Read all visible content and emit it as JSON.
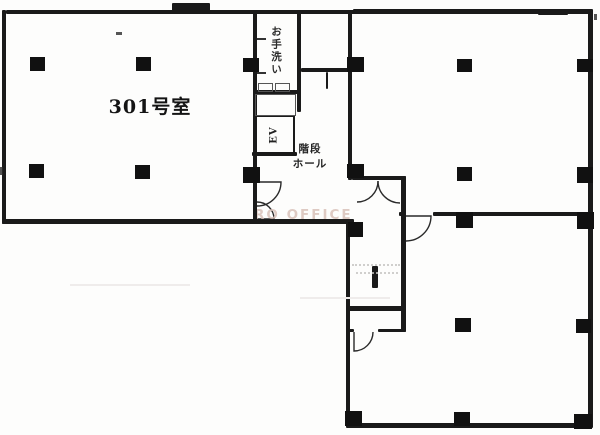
{
  "labels": {
    "room_301": "301号室",
    "restroom": "お手洗い",
    "elevator": "EV",
    "stair_hall_line1": "階段",
    "stair_hall_line2": "ホール",
    "watermark": "RO OFFICE"
  },
  "colors": {
    "wall": "#1a1a1a",
    "column": "#111111",
    "watermark": "#d9c2ba",
    "background": "#fdfdfc"
  }
}
